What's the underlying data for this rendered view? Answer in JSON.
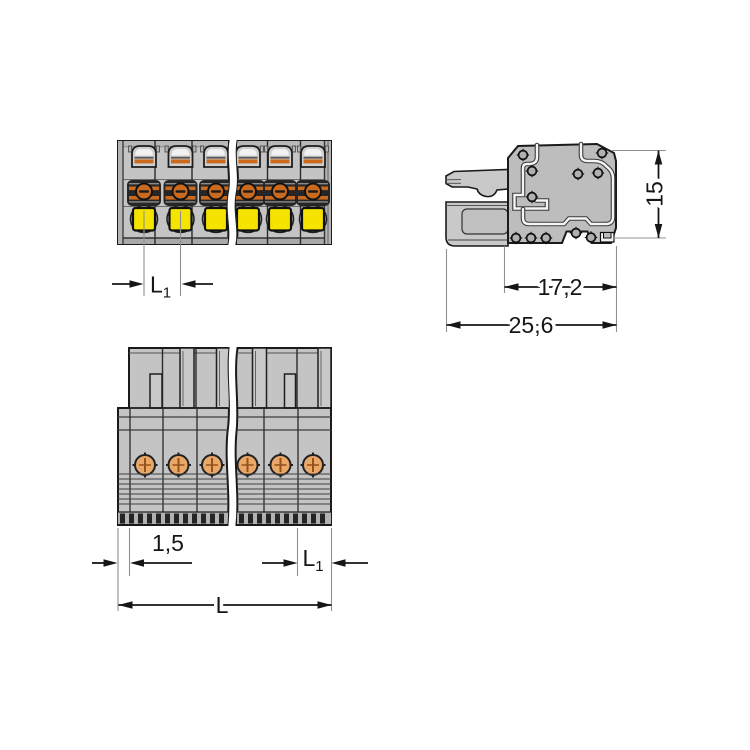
{
  "drawing": {
    "type": "technical-drawing",
    "views": {
      "front_view": "front-view-of-female-connector",
      "side_view": "side-view-of-female-connector",
      "bottom_view": "conductor-entry-view-of-female-connector"
    }
  },
  "dimensions": {
    "front_pitch": {
      "base": "L",
      "sub": "1"
    },
    "housing_depth": "17,2",
    "total_depth": "25,6",
    "height": "15",
    "edge_offset": "1,5",
    "bottom_pitch": {
      "base": "L",
      "sub": "1"
    },
    "total_length": "L"
  },
  "colors": {
    "housing_gray": "#c4c4c4",
    "housing_mid": "#b4b4b4",
    "housing_dark": "#a9a9a9",
    "side_body_gray": "#bdbdbd",
    "lever_gray": "#c9c9c9",
    "outline": "#1a1a1a",
    "button_yellow": "#f5e400",
    "contact_orange": "#c96a1e",
    "screw_orange": "#e9a768",
    "groove_white": "#f4f4f4",
    "extension_line": "#909090",
    "dimension_text": "#161616"
  }
}
